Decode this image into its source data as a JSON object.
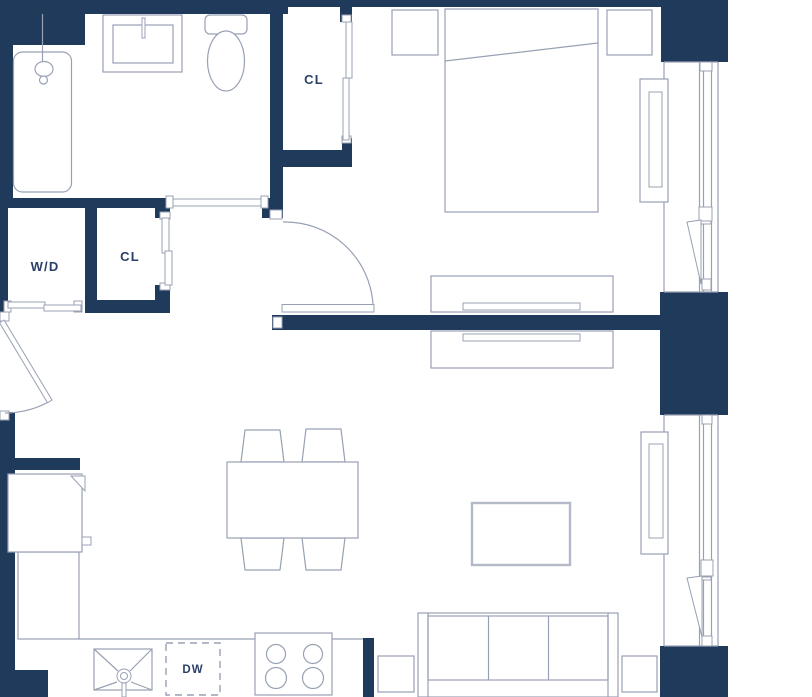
{
  "plan": {
    "name": "studio-apartment-floor-plan",
    "labels": {
      "closet_top": "CL",
      "closet_hall": "CL",
      "washer_dryer": "W/D",
      "dishwasher": "DW"
    },
    "colors": {
      "wall": "#203a5c",
      "line": "#98a1b3",
      "line_light": "#b3b9c6",
      "label": "#2a4068",
      "bg": "#ffffff"
    }
  }
}
